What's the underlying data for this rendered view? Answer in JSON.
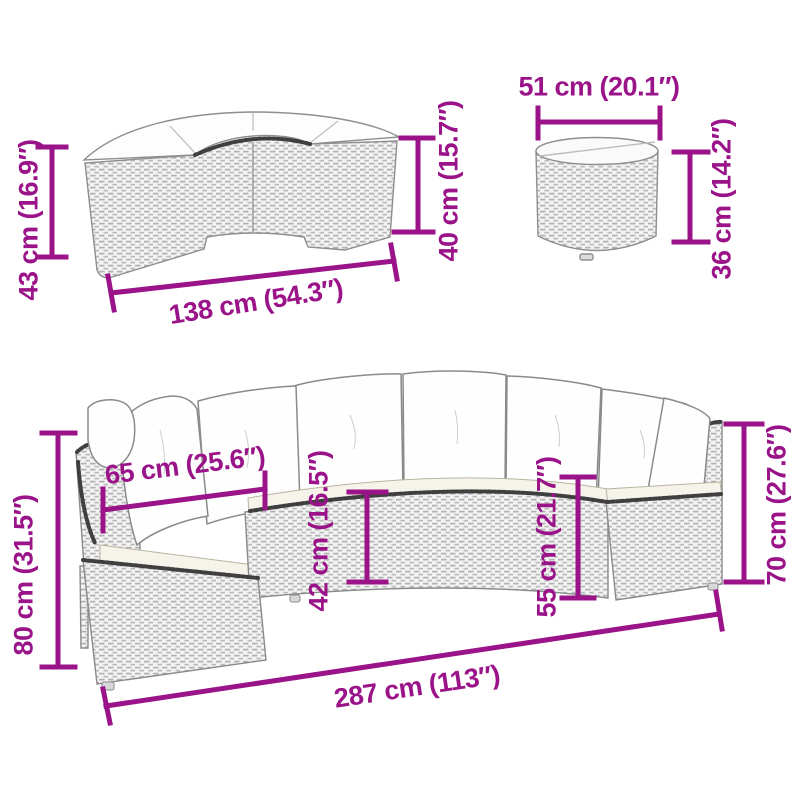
{
  "diagram": {
    "pieces": {
      "bench": "half-round ottoman with cushion",
      "table": "round side table",
      "sofa": "half-round sofa with cushions"
    }
  },
  "annotations": {
    "bench_height": "43 cm (16.9″)",
    "bench_width": "138 cm (54.3″)",
    "bench_seat_height": "40 cm (15.7″)",
    "table_diameter": "51 cm (20.1″)",
    "table_height": "36 cm (14.2″)",
    "sofa_height": "80 cm (31.5″)",
    "sofa_seat_width": "65 cm (25.6″)",
    "sofa_seat_front_height": "42 cm (16.5″)",
    "sofa_back_seat_height": "55 cm (21.7″)",
    "sofa_arm_height": "70 cm (27.6″)",
    "sofa_total_width": "287 cm (113″)"
  },
  "colors": {
    "dimension_accent": "#9A1388",
    "outline_gray": "#8E8E8E",
    "rattan_fill": "#F3F3F3",
    "rattan_weave": "#B2B2B2",
    "braid_edge": "#3F3F3F",
    "cushion_white": "#FEFEFE",
    "seat_cream": "#F6F4EA",
    "background": "#FFFFFF"
  }
}
